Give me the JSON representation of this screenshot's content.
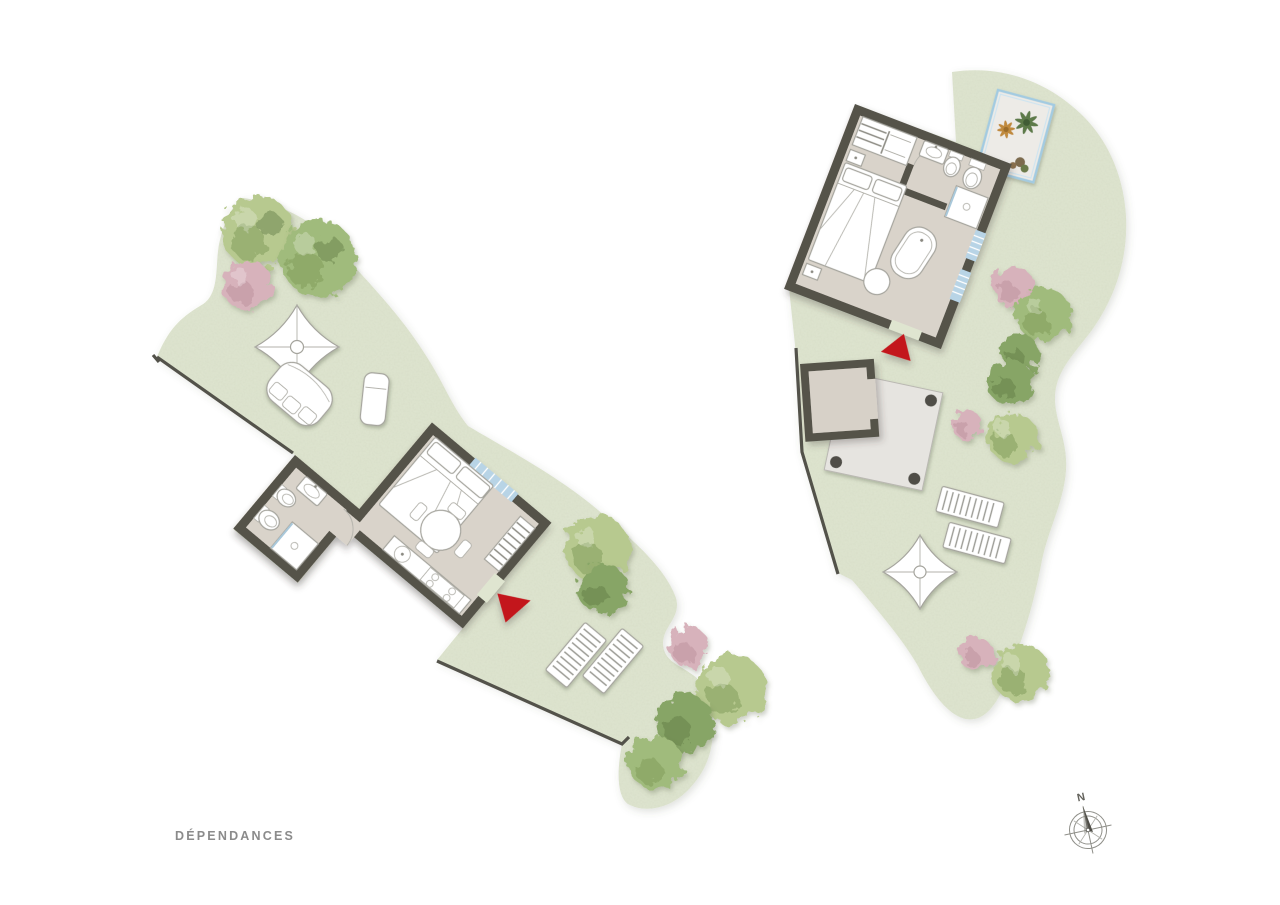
{
  "page": {
    "title": "DÉPENDANCES"
  },
  "compass": {
    "label": "N"
  },
  "colors": {
    "background": "#ffffff",
    "grass": "#dfe5d0",
    "property_line": "#53524a",
    "wall": "#54524a",
    "floor": "#d9d3ca",
    "terrace": "#e6e4e0",
    "shed_floor": "#d7d1c8",
    "courtyard": "#edebe7",
    "courtyard_border": "#a3cbe1",
    "window": "#b8d4e6",
    "accent_red": "#c3151b",
    "tree_green_light": "#b7c98f",
    "tree_green_mid": "#a0bb7b",
    "tree_green_dark": "#87a566",
    "tree_pink": "#d7b2bb",
    "title_color": "#8b8b8b"
  }
}
